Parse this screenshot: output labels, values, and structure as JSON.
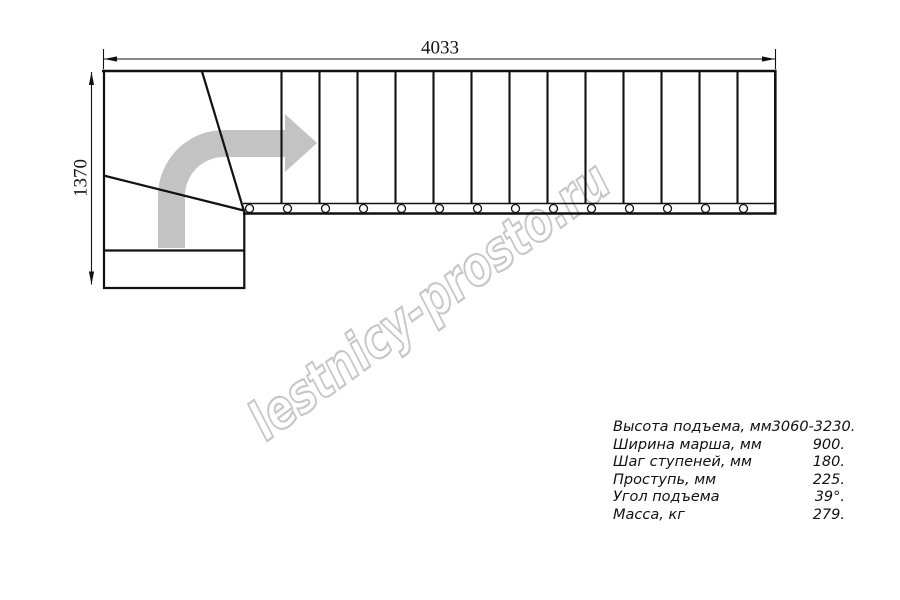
{
  "page": {
    "background": "#ffffff"
  },
  "drawing": {
    "type": "stair-plan-top-view",
    "width_label": "4033",
    "height_label": "1370",
    "flight": {
      "step_count": 14
    },
    "direction_arrow_icon": "curved-arrow-up-then-right",
    "colors": {
      "line": "#111111",
      "arrow_fill": "#c3c3c3",
      "watermark": "#c7c7c7"
    }
  },
  "watermark": {
    "text": "lestnicy-prosto.ru"
  },
  "specs": {
    "rows": [
      {
        "label": "Высота подъема, мм",
        "value": "3060-3230."
      },
      {
        "label": "Ширина марша, мм",
        "value": "900."
      },
      {
        "label": "Шаг ступеней, мм",
        "value": "180."
      },
      {
        "label": "Проступь, мм",
        "value": "225."
      },
      {
        "label": "Угол подъема",
        "value": "39°."
      },
      {
        "label": "Масса, кг",
        "value": "279."
      }
    ]
  }
}
